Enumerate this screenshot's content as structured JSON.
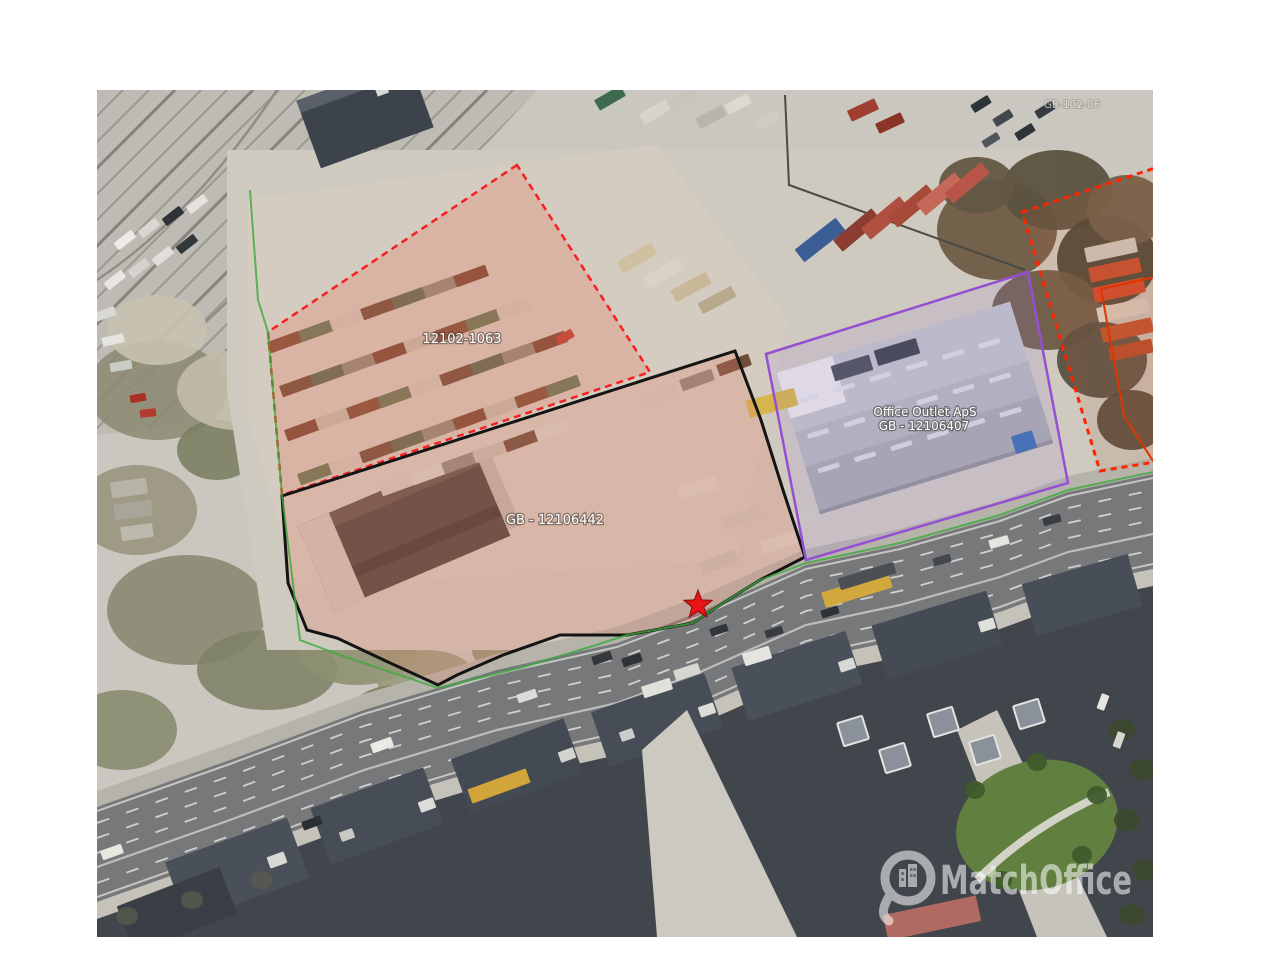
{
  "map": {
    "type": "satellite-aerial-photo",
    "plots": [
      {
        "id": "plot-12102-1063",
        "label": "12102-1063",
        "boundary_color": "#f52020",
        "boundary_style": "dashed",
        "fill": "rgba(228,122,100,0.30)"
      },
      {
        "id": "plot-gb-12106442",
        "label": "GB - 12106442",
        "boundary_color": "#141414",
        "boundary_style": "solid",
        "fill": "rgba(228,130,108,0.28)"
      },
      {
        "id": "plot-gb-12106407",
        "label_line1": "Office Outlet ApS",
        "label_line2": "GB - 12106407",
        "boundary_color": "#9550d2",
        "boundary_style": "solid",
        "fill": "rgba(165,125,225,0.14)"
      },
      {
        "id": "plot-right-dashed",
        "label": "GB-102-06",
        "boundary_color": "#ff2400",
        "boundary_style": "dashed",
        "fill": "rgba(205,95,60,0.12)"
      }
    ],
    "marker": {
      "shape": "star",
      "color": "#e61414",
      "outline": "#8a0d0d"
    },
    "municipal_boundary_color": "#3da93d"
  },
  "watermark": {
    "text": "MatchOffice",
    "icon": "map-pin-building-icon",
    "color": "#ffffff"
  }
}
